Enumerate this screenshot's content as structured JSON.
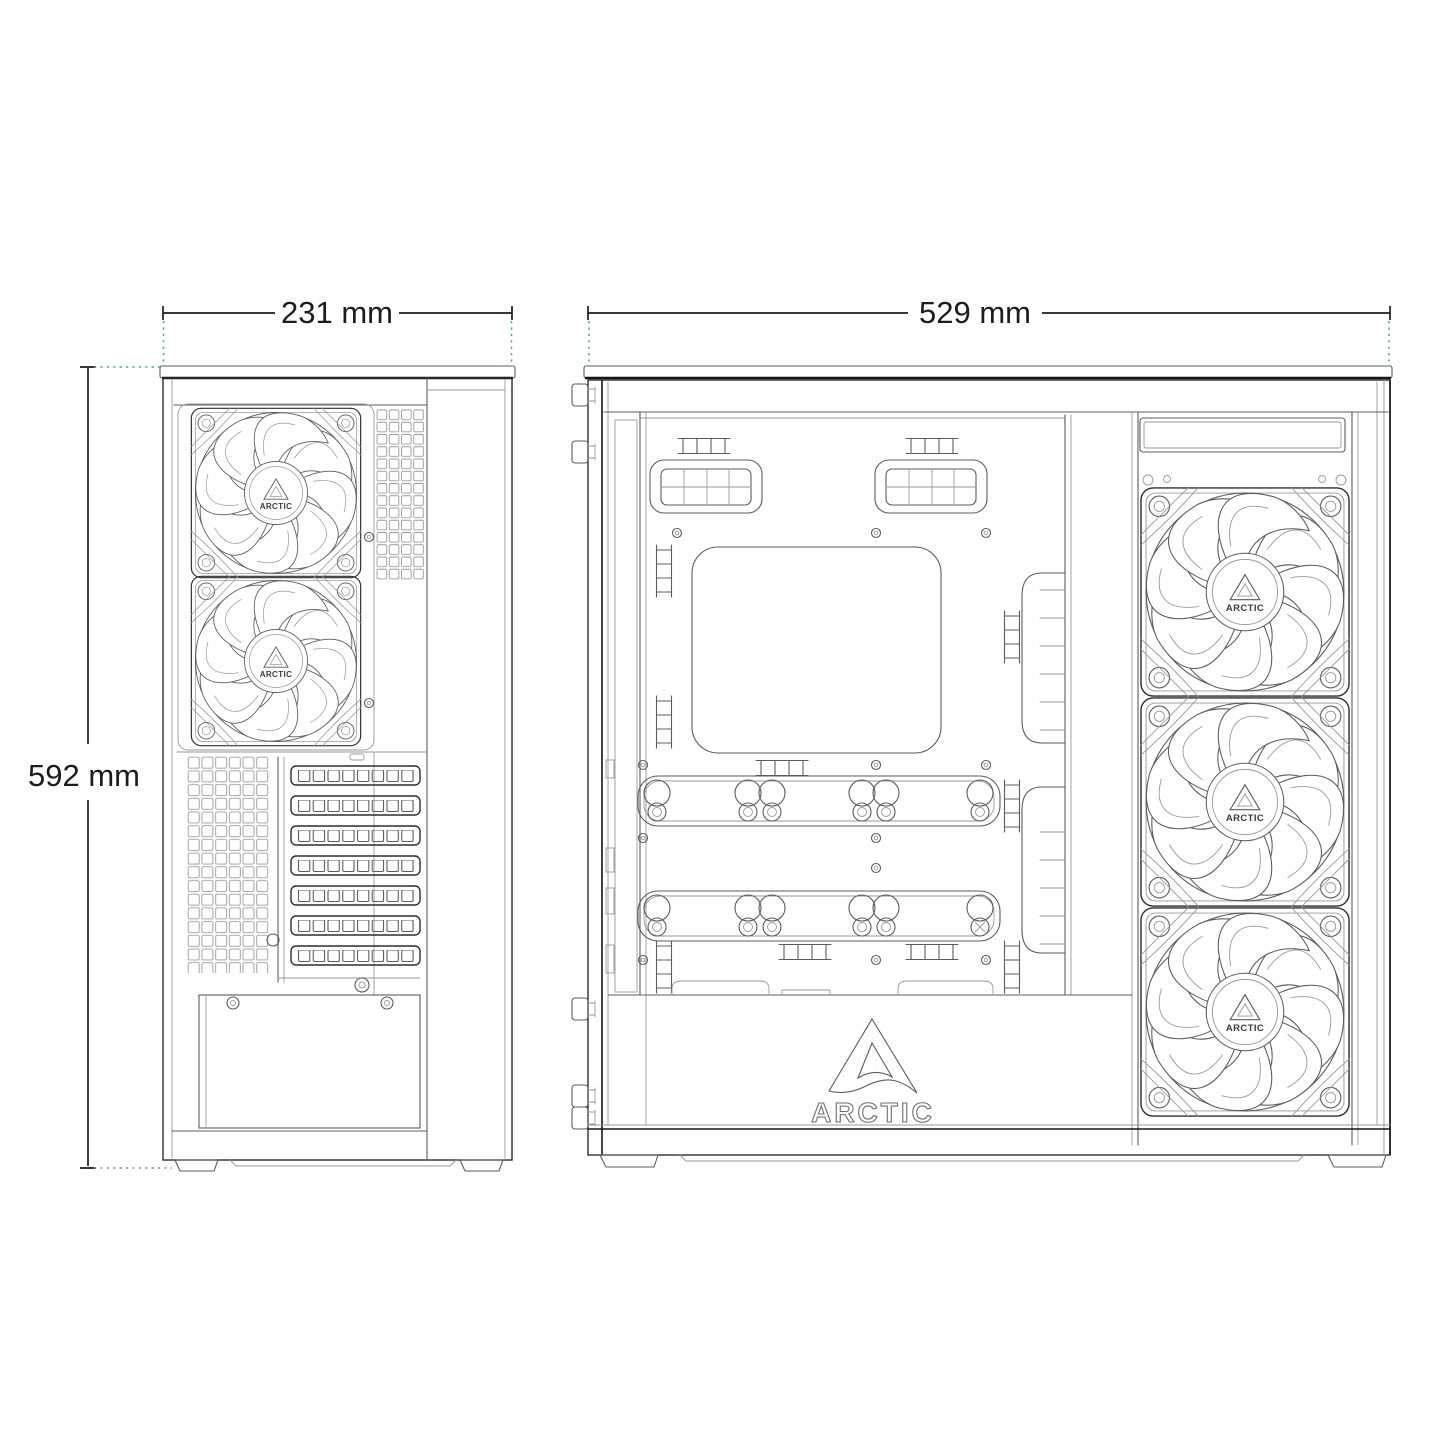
{
  "brand": {
    "name": "ARCTIC"
  },
  "dimensions": {
    "front_width": {
      "label": "231 mm",
      "value": 231,
      "unit": "mm"
    },
    "side_width": {
      "label": "529 mm",
      "value": 529,
      "unit": "mm"
    },
    "height": {
      "label": "592 mm",
      "value": 592,
      "unit": "mm"
    }
  },
  "colors": {
    "background": "#ffffff",
    "dark": "#161616",
    "line": "#2e2e2e",
    "mid": "#5c5c5c",
    "light": "#9a9a9a",
    "extension": "#4aa2b2",
    "text": "#1c1c1c"
  }
}
